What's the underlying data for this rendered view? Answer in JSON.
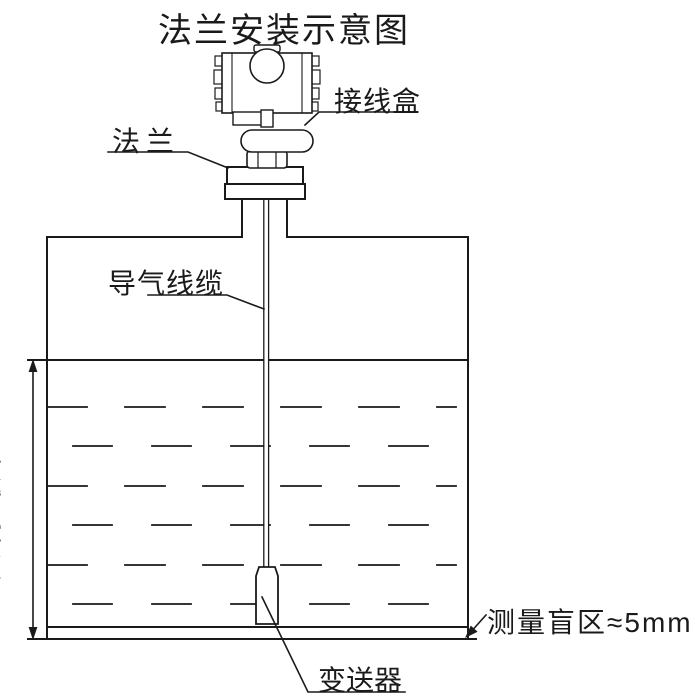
{
  "title": "法兰安装示意图",
  "labels": {
    "flange": "法兰",
    "junction_box": "接线盒",
    "air_cable": "导气线缆",
    "actual_level": "实际液位",
    "transmitter": "变送器",
    "blind_zone": "测量盲区≈5mm"
  },
  "colors": {
    "line": "#1a1a1a",
    "background": "#ffffff"
  }
}
